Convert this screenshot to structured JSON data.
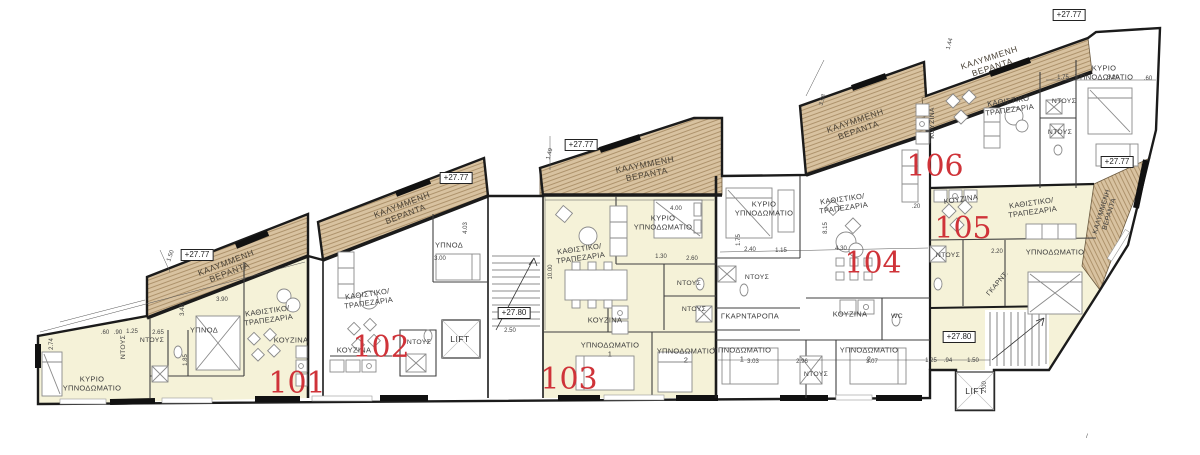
{
  "page": {
    "description": "Typical floor plan of apartment building – units 101 to 106"
  },
  "colors": {
    "apartment_fill": "#f5f2d8",
    "veranda_fill": "#d8c2a0",
    "veranda_hatch_line": "#a98e66",
    "wall": "#1b1b1b",
    "partition": "#3f3f3f",
    "furniture": "#8a8a8a",
    "unit_number": "#cf3339",
    "label_text": "#3b3b3b"
  },
  "units": {
    "u101": "101",
    "u102": "102",
    "u103": "103",
    "u104": "104",
    "u105": "105",
    "u106": "106"
  },
  "room_labels": {
    "veranda": "ΚΑΛΥΜΜΕΝΗ\nΒΕΡΑΝΤΑ",
    "living": "ΚΑΘΙΣΤΙΚΟ/\nΤΡΑΠΕΖΑΡΙΑ",
    "living_plain": "ΚΑΘΙΣΤΙΚΟ\nΤΡΑΠΕΖΑΡΙΑ",
    "master_bedroom": "ΚΥΡΙΟ\nΥΠΝΟΔΩΜΑΤΙΟ",
    "bedroom": "ΥΠΝΟΔΩΜΑΤΙΟ",
    "bedroom_1": "ΥΠΝΟΔΩΜΑΤΙΟ\n1",
    "bedroom_2": "ΥΠΝΟΔΩΜΑΤΙΟ\n2",
    "bedroom_short": "ΥΠΝΟΔ",
    "kitchen": "ΚΟΥΖΙΝΑ",
    "shower": "ΝΤΟΥΣ",
    "wc": "WC",
    "wardrobe": "ΓΚΑΡΝΤΑΡΟΠΑ",
    "wardrobe_short": "ΓΚΑΡΝΤ.",
    "lift": "LIFT"
  },
  "elevations": {
    "level_2777": "+27.77",
    "level_2780": "+27.80"
  },
  "dims": [
    "2.74",
    ".60",
    ".90",
    "1.25",
    "2.65",
    "3.48",
    "1.85",
    "3.90",
    "1.50",
    "4.03",
    "3.00",
    "10.00",
    "1.49",
    "4.00",
    "1.30",
    "2.60",
    "3.03",
    "2.96",
    "3.07",
    "4.30",
    "1.15",
    "2.40",
    "1.75",
    "1.75",
    "3.20",
    ".60",
    "2.20",
    "1.25",
    ".94",
    "1.50",
    "2.00",
    "3.98",
    "1.44",
    "2.50",
    "8.15",
    ".20",
    "/"
  ]
}
